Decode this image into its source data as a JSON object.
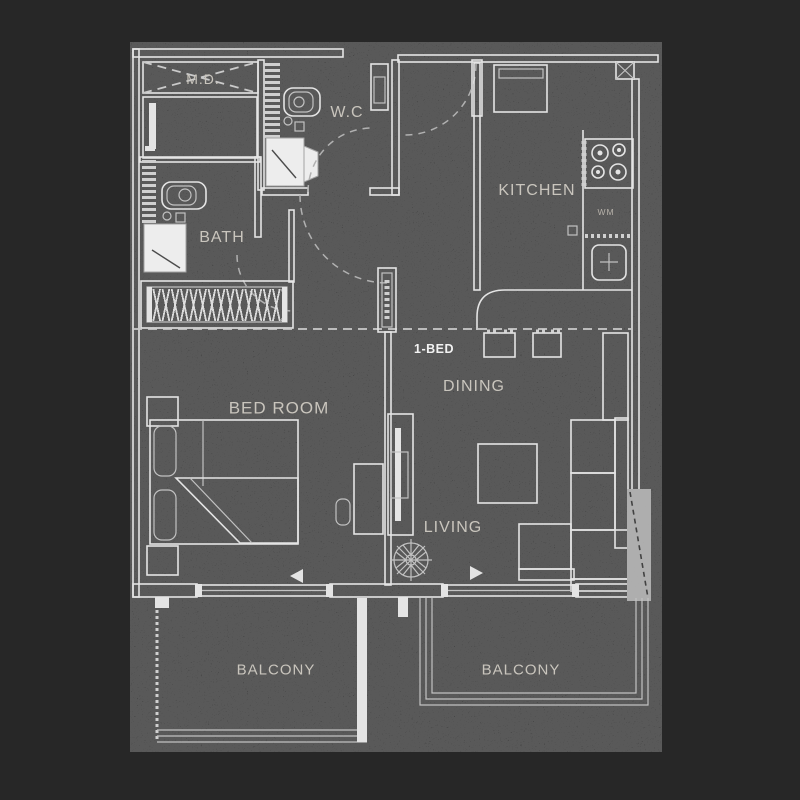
{
  "floorplan": {
    "unit_type_label": "1-BED",
    "rooms": {
      "md": "M.D.",
      "wc": "W.C",
      "bath": "BATH",
      "kitchen": "KITCHEN",
      "washing_machine": "WM",
      "dining": "DINING",
      "bedroom": "BED ROOM",
      "living": "LIVING",
      "balcony_left": "BALCONY",
      "balcony_right": "BALCONY"
    },
    "colors": {
      "page_bg": "#272727",
      "plan_bg": "#0e0e0e",
      "line": "#e4e4e4",
      "label": "#c9c5bd",
      "accent_label": "#f2f2f2",
      "column_fill": "#a7a7a7"
    }
  }
}
